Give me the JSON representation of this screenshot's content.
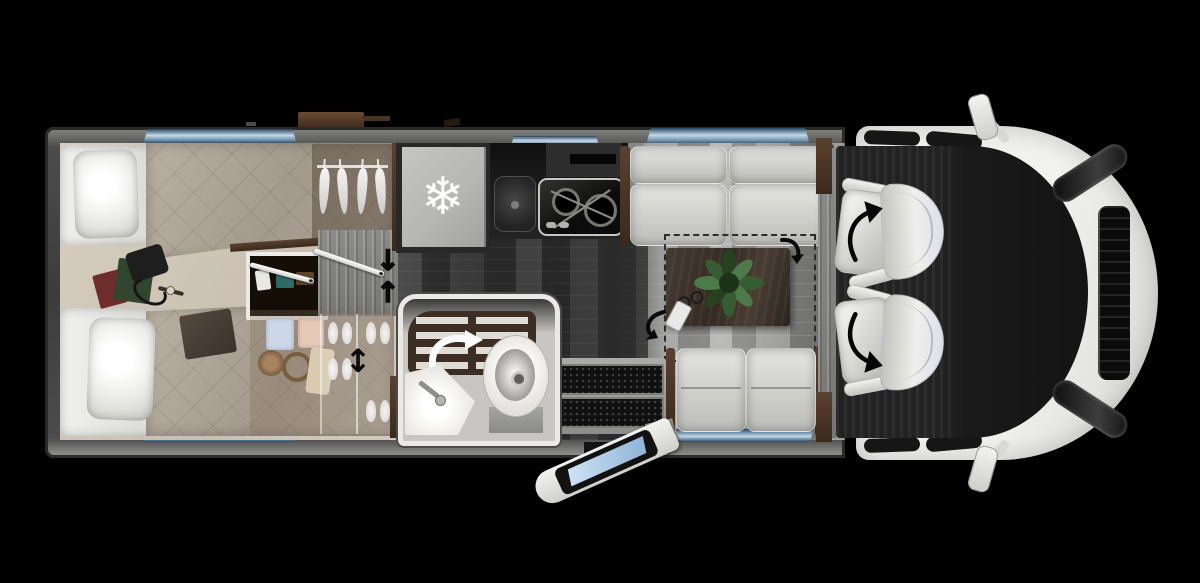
{
  "scene": {
    "type": "motorhome floor plan, top-down view",
    "vehicle_front_side": "right",
    "background": "black"
  },
  "palette": {
    "bg": "#000000",
    "wall": "#4d4d4d",
    "wall-edge": "#2e2e2e",
    "wall-light": "#a2a2a0",
    "win-deep": "#27455f",
    "win-light": "#c3d7e8",
    "win-mid": "#7596b1",
    "bed-base": "#e9e9e7",
    "duvet-hi": "#b9b0a3",
    "duvet-lo": "#a3998c",
    "bedroom-floor": "#d3cabc",
    "wood": "#5a412f",
    "wood-dark": "#3a2a1c",
    "fridge-face": "#b7b7b5",
    "appliance": "#1b1b1b",
    "steel": "#c6c6c4",
    "sofa-hi": "#e4e4e2",
    "sofa-lo": "#bcbcb9",
    "table-wood": "#352b23",
    "plant-green": "#3c6240",
    "floor-dark": "#2e2e2e",
    "floor-light": "#939391",
    "bath-floor": "#c7c6c2",
    "bath-wall": "#eae9e5",
    "shower-wood": "#3c2e24",
    "slat": "#e0dcd4",
    "porcelain": "#f2f1ed",
    "cab-floor": "#222222",
    "seat-hi": "#efefed",
    "seat-lo": "#c0c0bd",
    "body-white": "#ebebe9",
    "glass": "#141414",
    "ink": "#0a0a0a",
    "door-glass-hi": "#cfe2f4",
    "door-glass-lo": "#8fb3d6"
  },
  "icons": {
    "snowflake": "❄",
    "slide_door_down": "↓",
    "slide_door_up": "↑",
    "height_adjust": "↕"
  },
  "bedroom": {
    "bed_count": 2,
    "wardrobe_hangers": 4,
    "shoe_count": 8
  },
  "kitchen": {
    "burner_count": 2
  },
  "entry": {
    "step_count": 2
  },
  "cab": {
    "swivel_seat_count": 2
  }
}
